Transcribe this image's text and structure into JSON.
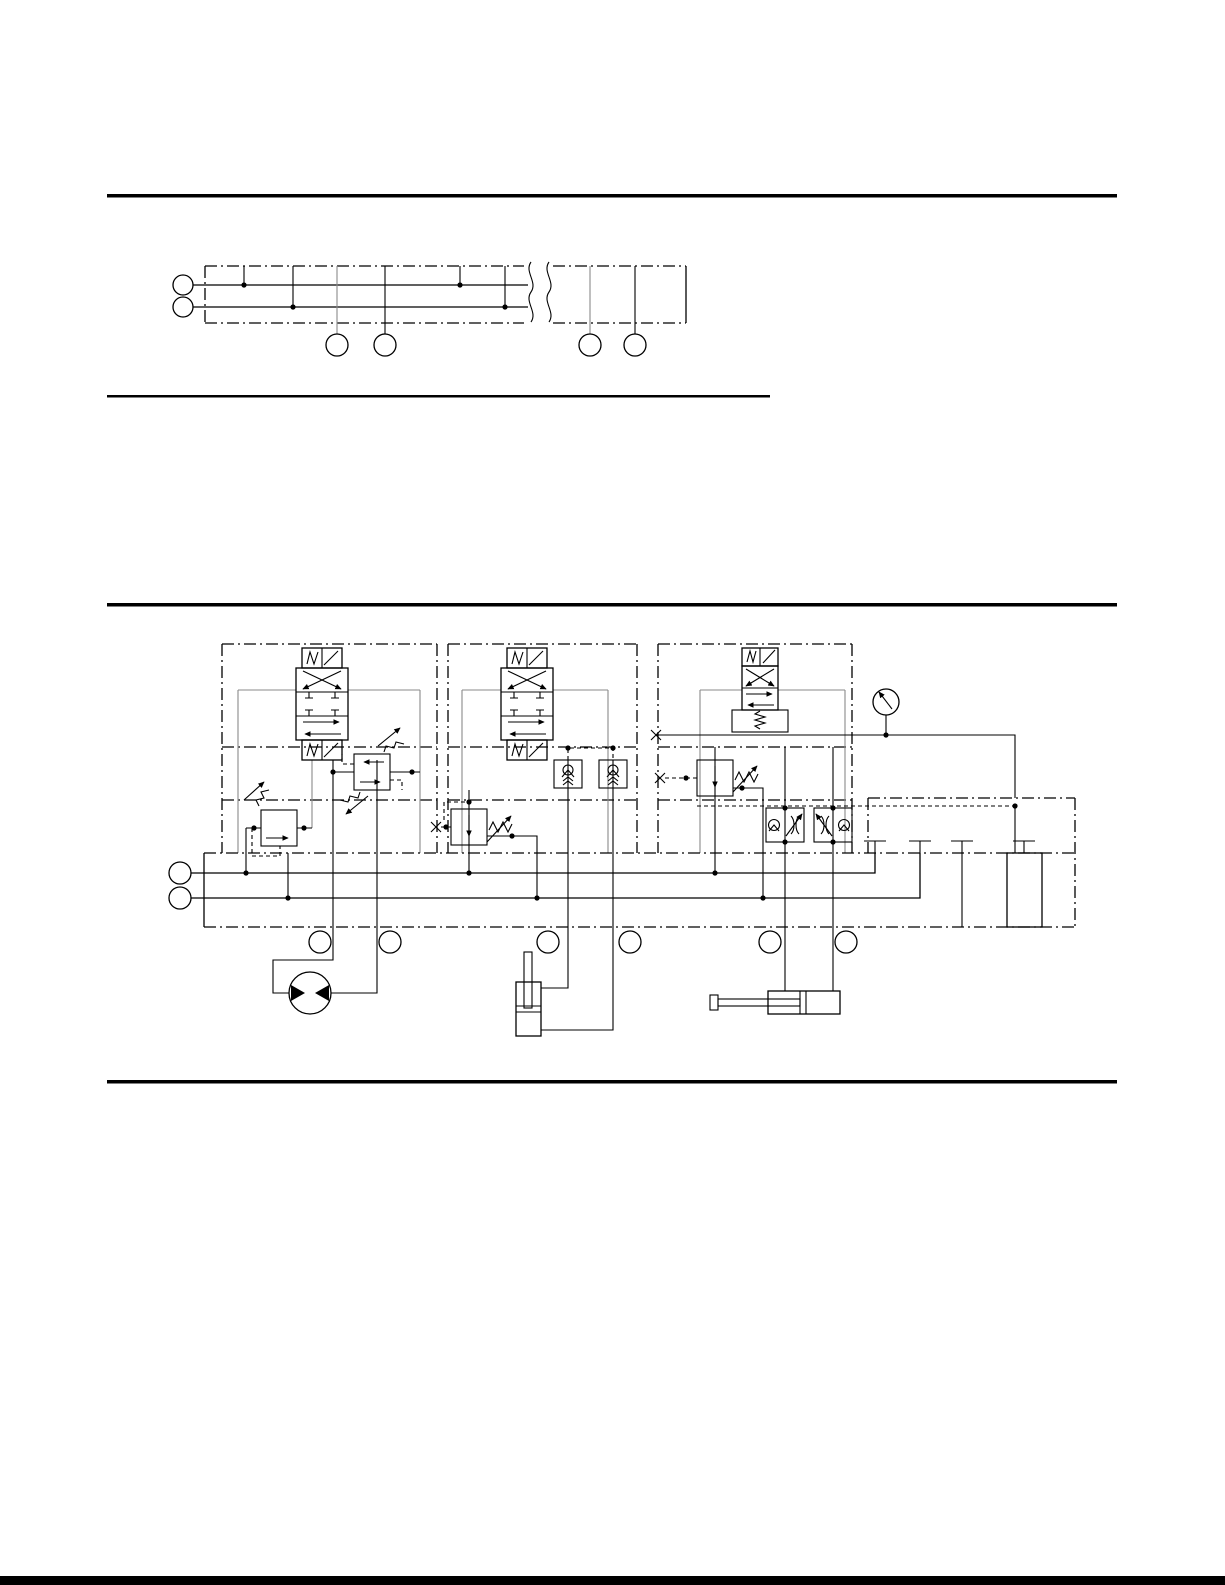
{
  "page": {
    "width": 1225,
    "height": 1585,
    "background": "#ffffff"
  },
  "colors": {
    "line": "#000000",
    "work_line": "#8a8a8a",
    "page_bg": "#ffffff"
  },
  "rules": {
    "count": 4,
    "note": "horizontal section rules; no visible text on page"
  },
  "figures": {
    "top_figure": {
      "description": "Abbreviated manifold outline: two supply port circles at left, dash-dot manifold envelope with pressure and tank rails, break lines, and four unlabeled port circles below",
      "supply_port_circles": 2,
      "port_label_circles": 4
    },
    "main_figure": {
      "description": "Hydraulic stack-valve circuit: three solenoid valve stations on a common manifold base with P and T rails, pressure gauge, blanking plugs, end cover, and three actuators",
      "stations": [
        {
          "name": "station-1",
          "directional_valve": "4/3 solenoid operated, spring centered",
          "modules": [
            "dual cross-over relief valve",
            "pressure reducing valve"
          ],
          "actuator": "bidirectional hydraulic motor"
        },
        {
          "name": "station-2",
          "directional_valve": "4/3 solenoid operated, spring centered",
          "modules": [
            "dual pilot-operated check valve",
            "pressure reducing valve"
          ],
          "actuator": "single-rod cylinder, vertical"
        },
        {
          "name": "station-3",
          "directional_valve": "4/2 solenoid operated, spring return",
          "modules": [
            "pressure reducing valve",
            "two throttle-check flow controls"
          ],
          "actuator": "single-rod cylinder, horizontal"
        }
      ],
      "gauge": "pressure gauge",
      "manifold": {
        "supply_port_circles": 2,
        "work_port_label_circles": 6,
        "blanking_plugs": 4,
        "end_cover": true
      }
    }
  }
}
